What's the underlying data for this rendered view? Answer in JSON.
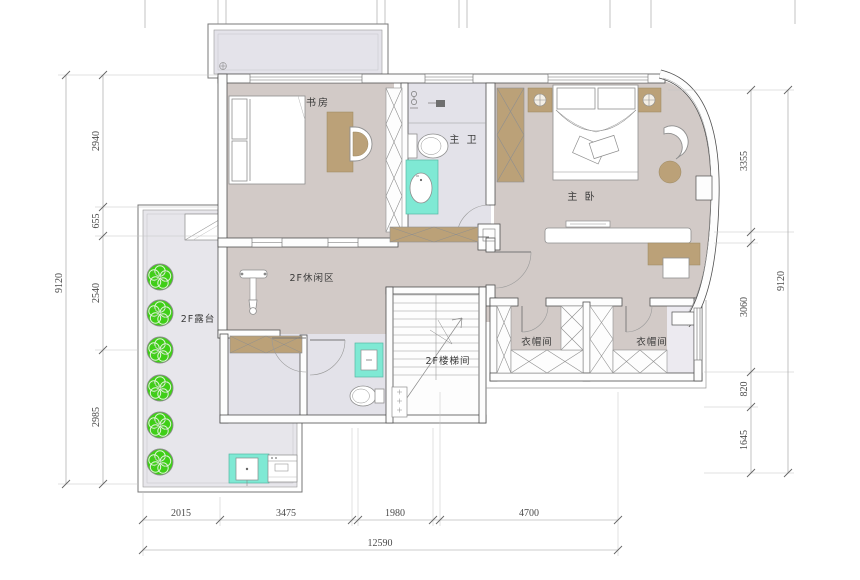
{
  "plan": {
    "title": "2F floor plan",
    "rooms": {
      "study": "书房",
      "master_bath": "主 卫",
      "master_bedroom": "主 卧",
      "leisure": "2F休闲区",
      "terrace": "2F露台",
      "stairwell": "2F楼梯间",
      "closet_left": "衣帽间",
      "closet_right": "衣帽间"
    },
    "dimensions": {
      "left": {
        "total": "9120",
        "segments": [
          "2940",
          "655",
          "2540",
          "2985"
        ]
      },
      "right": {
        "total": "9120",
        "segments": [
          "3355",
          "3060",
          "820",
          "1645"
        ]
      },
      "bottom": {
        "total": "12590",
        "segments": [
          "2015",
          "3475",
          "1980",
          "4700"
        ]
      }
    },
    "colors": {
      "floor_warm": "#d2cac7",
      "floor_cool": "#e3e2e9",
      "terrace_floor": "#e7e6eb",
      "cabinet_tan": "#bba178",
      "fixture_teal": "#7fe9d4",
      "tree_green": "#3fcf17",
      "wall_line": "#4f4f4f",
      "dim_line": "#999999"
    }
  }
}
